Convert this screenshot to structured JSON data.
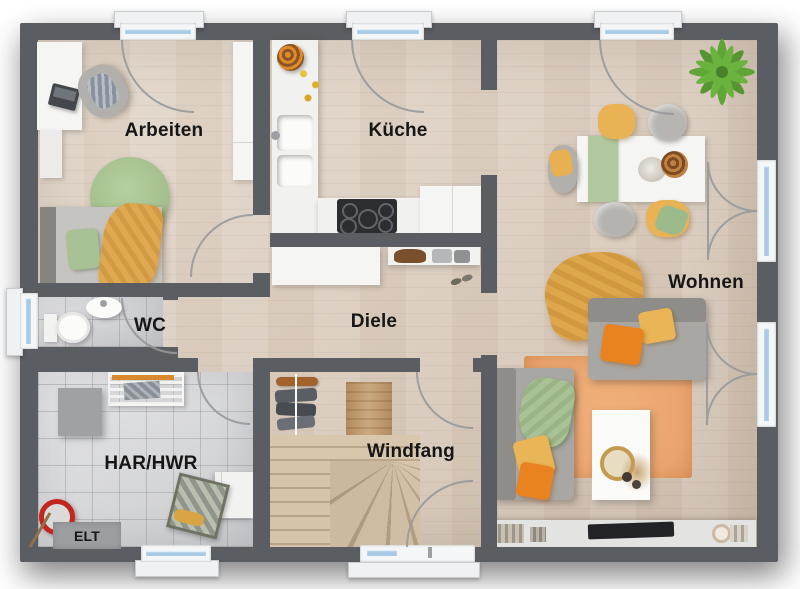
{
  "rooms": {
    "arbeiten": {
      "label": "Arbeiten"
    },
    "kueche": {
      "label": "Küche"
    },
    "wohnen": {
      "label": "Wohnen"
    },
    "wc": {
      "label": "WC"
    },
    "diele": {
      "label": "Diele"
    },
    "har_hwr": {
      "label": "HAR/HWR"
    },
    "windfang": {
      "label": "Windfang"
    },
    "elt": {
      "label": "ELT"
    }
  },
  "colors": {
    "wall": "#5a5e62",
    "wood_floor": "#decfc0",
    "tile_floor": "#d8d9db",
    "window_glass": "#a9cbe5",
    "accent_orange": "#e8831f",
    "accent_mustard": "#dfa74e",
    "accent_green": "#a9c295",
    "rug_orange": "#eda973",
    "label_text": "#161616"
  }
}
